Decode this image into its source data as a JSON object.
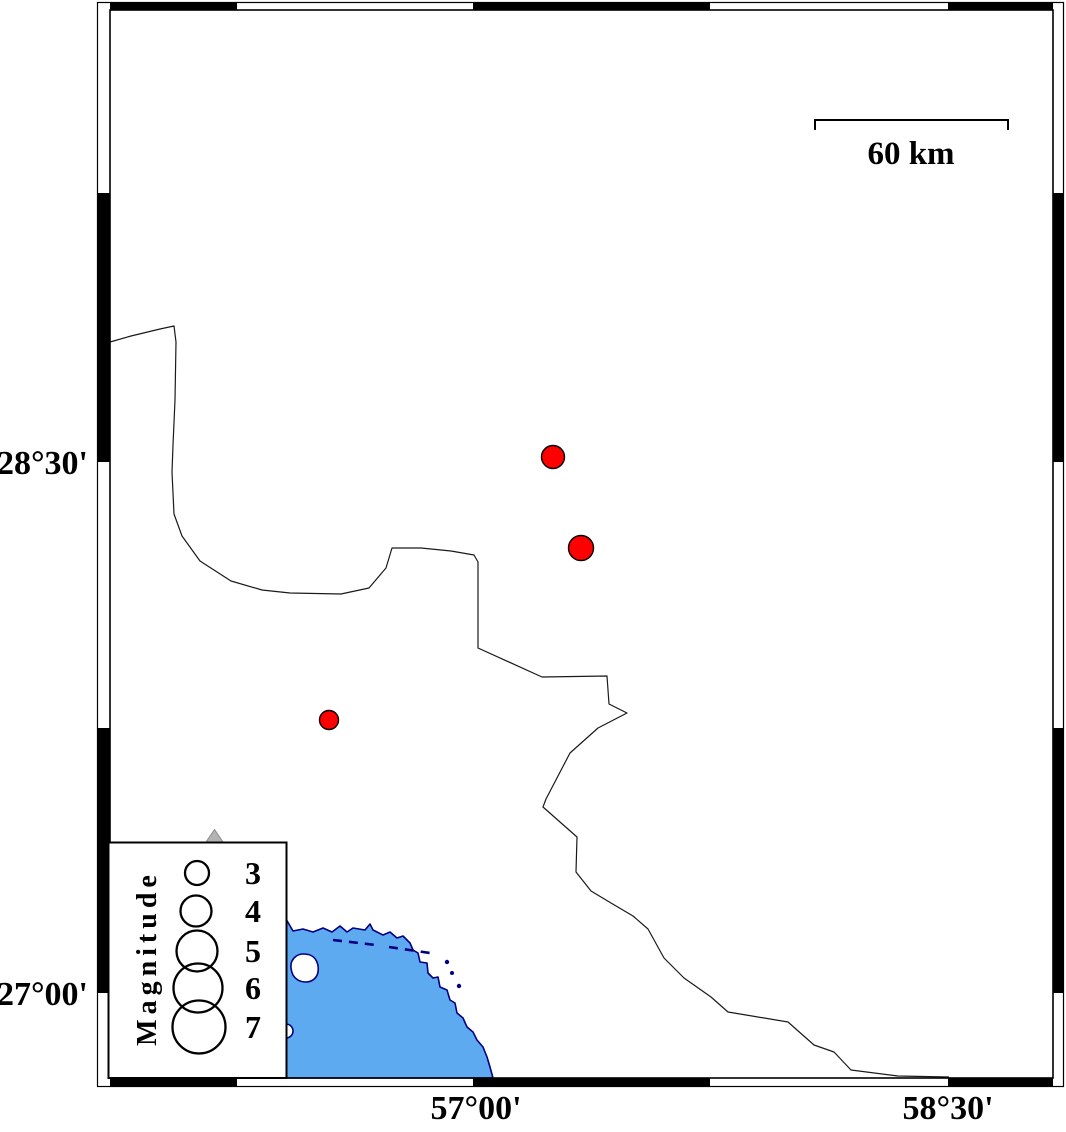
{
  "figure": {
    "kind": "earthquake-epicenter-map",
    "axis_labels": {
      "lat": [
        {
          "text": "28°30'",
          "x": 88,
          "y": 474
        },
        {
          "text": "27°00'",
          "x": 88,
          "y": 1005
        }
      ],
      "lon": [
        {
          "text": "57°00'",
          "x": 476,
          "y": 1119
        },
        {
          "text": "58°30'",
          "x": 948,
          "y": 1119
        }
      ]
    },
    "scale_bar": {
      "label": "60 km",
      "label_x": 911,
      "label_y": 164
    },
    "legend": {
      "title": "Magnitude",
      "label_x": 253,
      "entries": [
        {
          "magnitude": "3",
          "cx": 197,
          "cy": 873,
          "r": 12
        },
        {
          "magnitude": "4",
          "cx": 196,
          "cy": 911,
          "r": 15.5
        },
        {
          "magnitude": "5",
          "cx": 197,
          "cy": 951,
          "r": 20.5
        },
        {
          "magnitude": "6",
          "cx": 198,
          "cy": 988,
          "r": 24.5
        },
        {
          "magnitude": "7",
          "cx": 199,
          "cy": 1027,
          "r": 26.5
        }
      ]
    },
    "epicenters": [
      {
        "x": 553,
        "y": 457,
        "r": 11.5
      },
      {
        "x": 581,
        "y": 548,
        "r": 12.5
      },
      {
        "x": 329,
        "y": 720,
        "r": 9.5
      }
    ],
    "islets": [
      {
        "x": 447,
        "y": 962,
        "r": 2.2
      },
      {
        "x": 452,
        "y": 973,
        "r": 2.0
      },
      {
        "x": 459,
        "y": 986,
        "r": 2.2
      }
    ],
    "colors": {
      "sea": "#5EAAF1",
      "coastline": "#000080",
      "epicenter": "#FF0000",
      "volcano_fill": "#B3B3B3",
      "volcano_stroke": "#8C8C8C",
      "boundary": "#1A1A1A"
    },
    "paths": {
      "boundary": "M110,342 L131,336 L160,329 L174,326 L176,342 L175,400 L173,445 L172,472 L174,514 L182,536 L200,561 L231,581 L262,590 L290,593 L341,594 L369,588 L386,568 L392,548 L421,548 L451,551 L474,555 L478,562 L478,648 L542,677 L607,676 L609,704 L627,713 L598,728 L570,753 L546,799 L543,807 L577,837 L576,872 L591,891 L611,903 L633,916 L648,929 L664,958 L684,978 L711,997 L728,1012 L746,1015 L788,1022 L814,1045 L834,1052 L851,1070 L898,1076 L949,1077",
      "coast": "M110,916 L200,917 L286,919 L293,931 L303,929 L313,932 L323,928 L332,932 L340,926 L347,932 L353,928 L365,930 L370,924 L373,930 L383,935 L390,932 L397,938 L403,936 L410,943 L413,950 L418,953 L420,962 L427,963 L428,973 L433,978 L438,977 L440,987 L447,990 L450,1000 L455,1003 L457,1013 L463,1018 L467,1027 L473,1032 L477,1040 L483,1047 L487,1057 L490,1067 L493,1078 L110,1078 Z",
      "island": "M303,954 C298,954 294,957 292,961 C290,965 291,971 293,975 C296,980 301,982 306,982 C312,982 317,978 318,972 C319,966 317,959 312,956 C309,954 306,954 303,954 Z",
      "shoal_dashes": "M333,940 L376,945 M389,947 L430,953",
      "scale_bar": "M815,130 L815,120 L1008,120 L1008,130",
      "volcano_points": "214.5,829.5 205,843.5 224,843.5"
    }
  },
  "map_data": {
    "type": "epicenter-map",
    "longitude_ticks_deg_e": [
      57.0,
      58.5
    ],
    "latitude_ticks_deg_n": [
      27.0,
      28.5
    ],
    "scale_km": 60,
    "legend_magnitudes": [
      3,
      4,
      5,
      6,
      7
    ],
    "epicenters_approx": [
      {
        "lon_deg_e": 57.25,
        "lat_deg_n": 28.51,
        "magnitude_approx": 3
      },
      {
        "lon_deg_e": 57.34,
        "lat_deg_n": 28.26,
        "magnitude_approx": 3
      },
      {
        "lon_deg_e": 56.55,
        "lat_deg_n": 27.77,
        "magnitude_approx": 3
      }
    ]
  }
}
